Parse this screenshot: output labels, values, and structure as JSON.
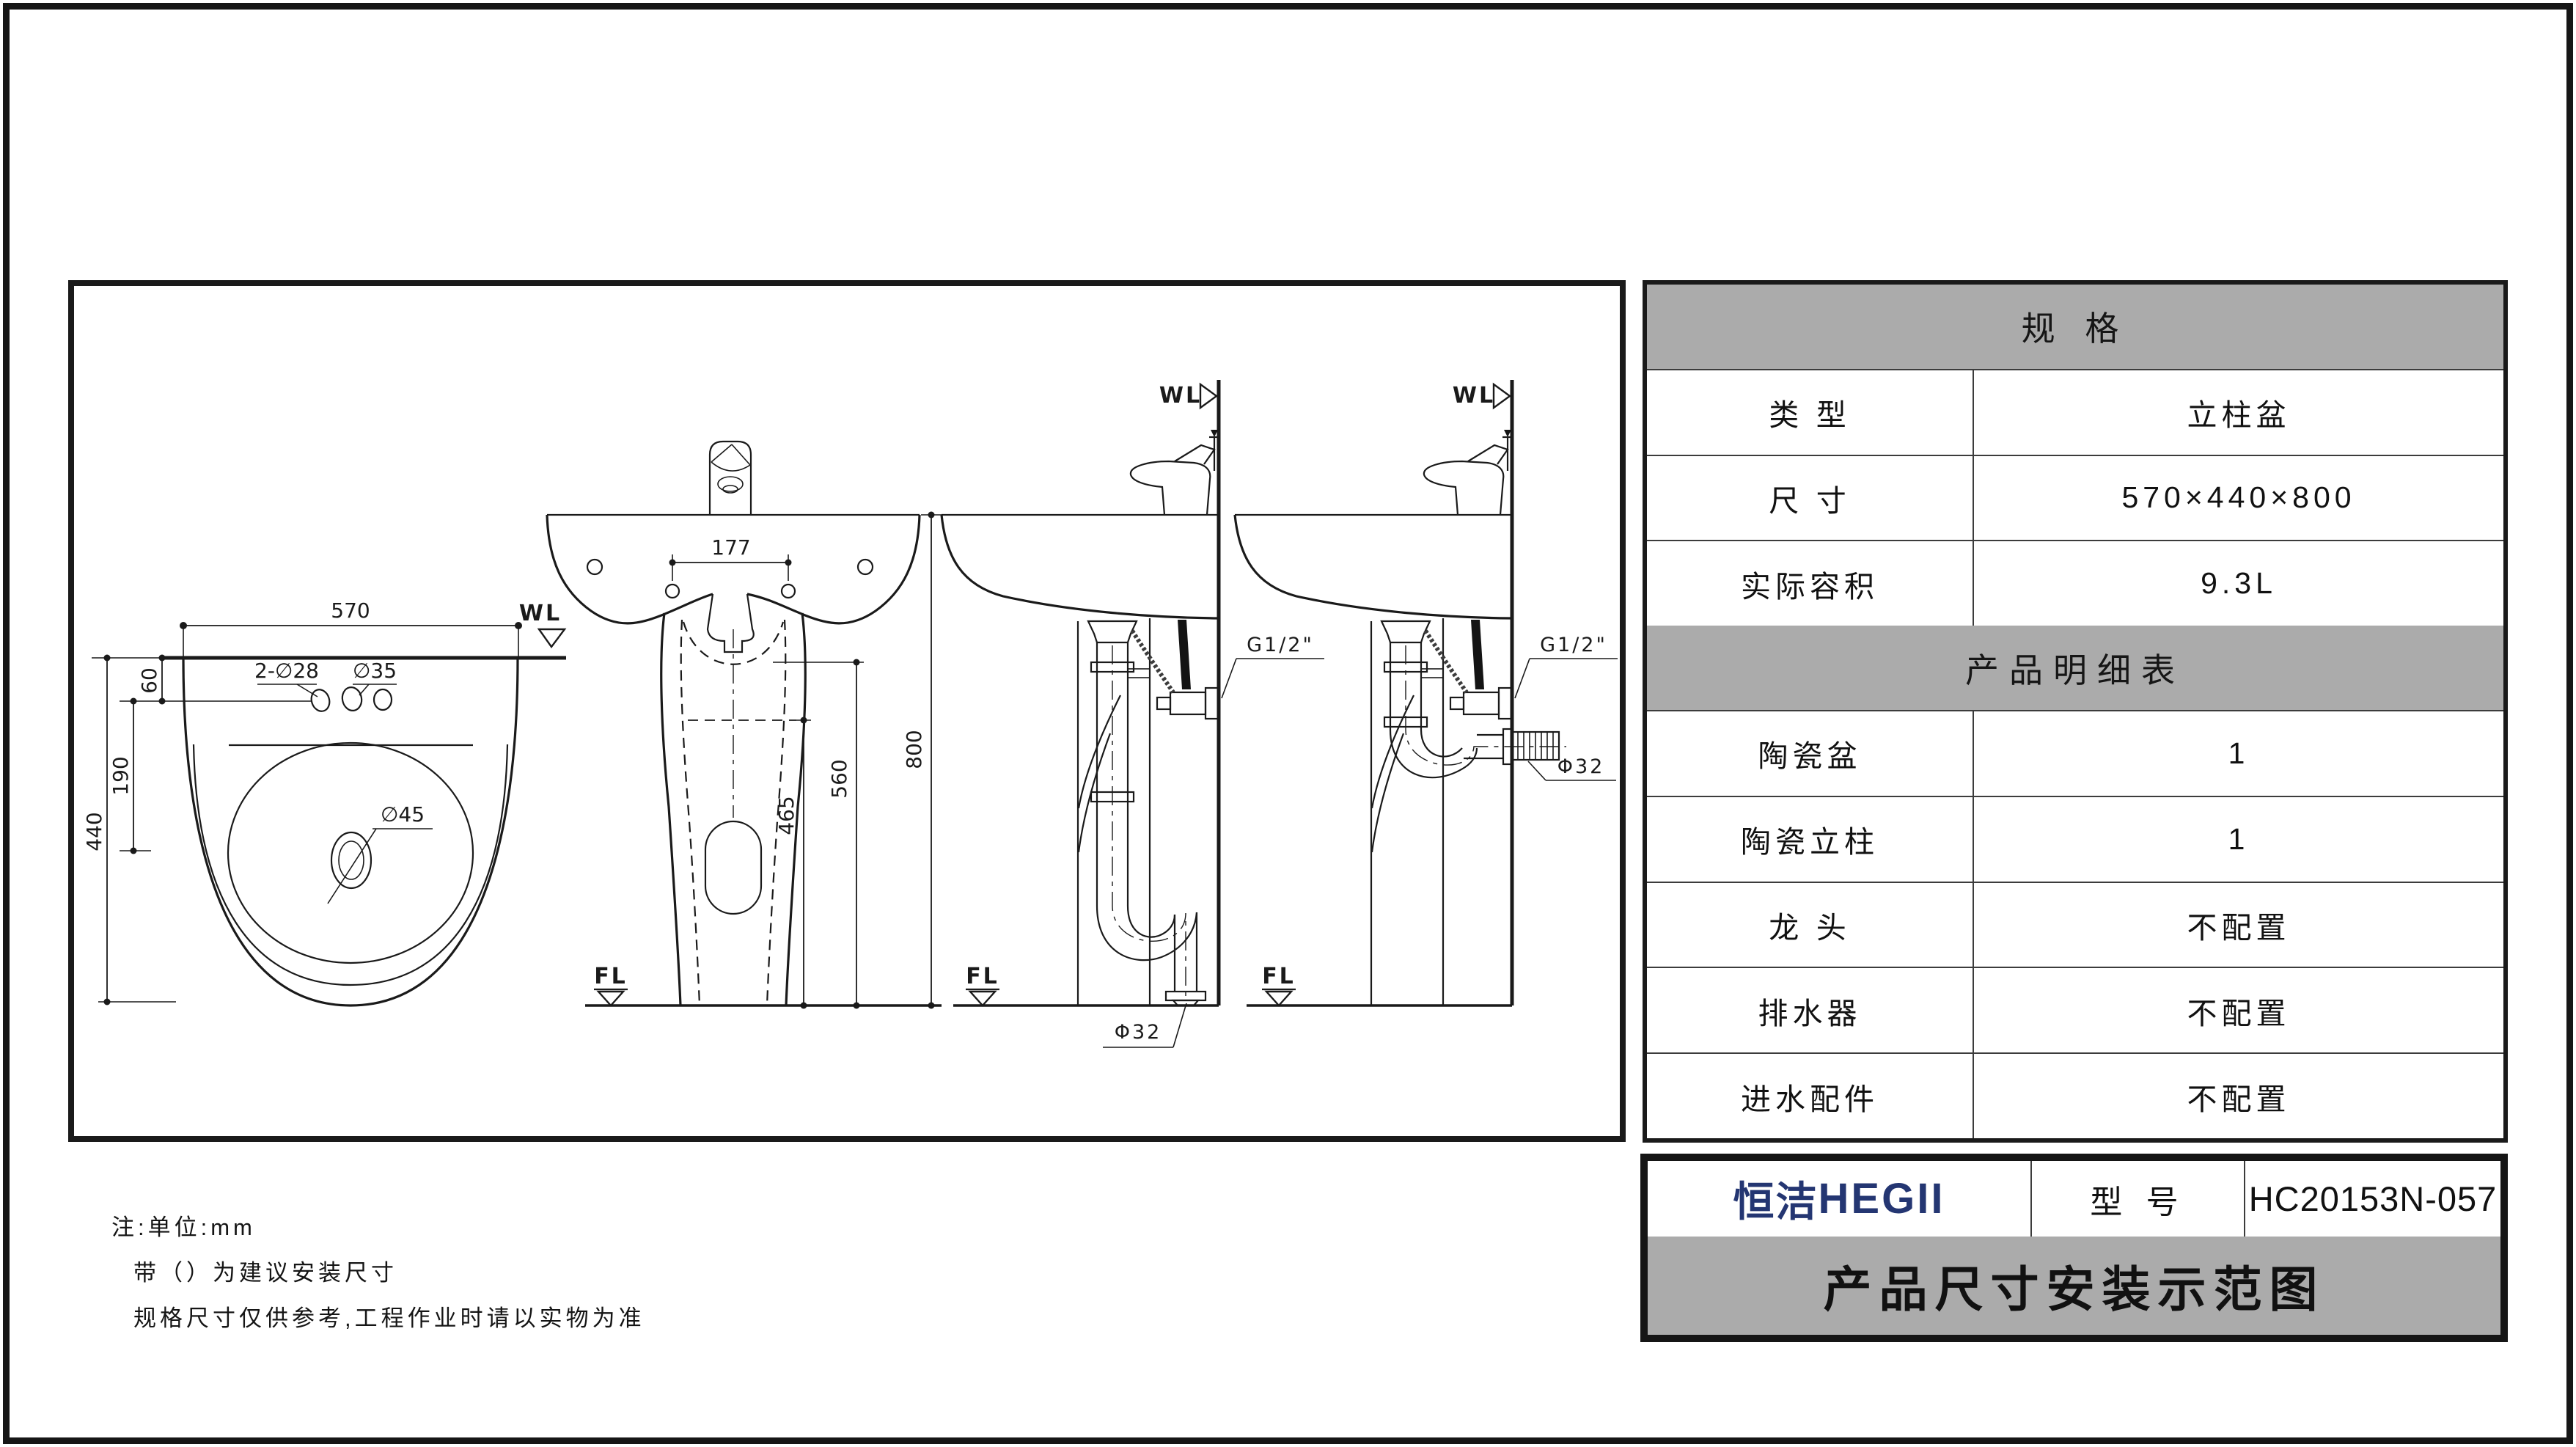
{
  "drawing": {
    "wl_label": "WL",
    "fl_label": "FL",
    "top_view": {
      "width_dim": "570",
      "depth_dim": "440",
      "bowl_offset_dim": "190",
      "hole_offset_dim": "60",
      "faucet_holes_label": "2-∅28",
      "center_hole_label": "∅35",
      "drain_label": "∅45"
    },
    "front_view": {
      "faucet_spacing_dim": "177",
      "height_dim": "800",
      "pedestal_top_dim": "560",
      "pedestal_mid_dim": "465"
    },
    "side_views": {
      "inlet_label": "G1/2\"",
      "drain_label": "Φ32"
    }
  },
  "spec_table": {
    "header": "规  格",
    "rows": [
      {
        "label": "类  型",
        "value": "立柱盆"
      },
      {
        "label": "尺  寸",
        "value": "570×440×800"
      },
      {
        "label": "实际容积",
        "value": "9.3L"
      }
    ],
    "detail_header": "产品明细表",
    "detail_rows": [
      {
        "label": "陶瓷盆",
        "value": "1"
      },
      {
        "label": "陶瓷立柱",
        "value": "1"
      },
      {
        "label": "龙  头",
        "value": "不配置"
      },
      {
        "label": "排水器",
        "value": "不配置"
      },
      {
        "label": "进水配件",
        "value": "不配置"
      }
    ]
  },
  "title_block": {
    "brand_cn": "恒洁",
    "brand_en": "HEGII",
    "model_label": "型 号",
    "model_value": "HC20153N-057",
    "title": "产品尺寸安装示范图"
  },
  "notes": {
    "line1": "注:单位:mm",
    "line2": "带（）为建议安装尺寸",
    "line3": "规格尺寸仅供参考,工程作业时请以实物为准"
  },
  "colors": {
    "brand_navy": "#243672",
    "table_gray": "#ababab",
    "line_black": "#1a1a1a"
  }
}
